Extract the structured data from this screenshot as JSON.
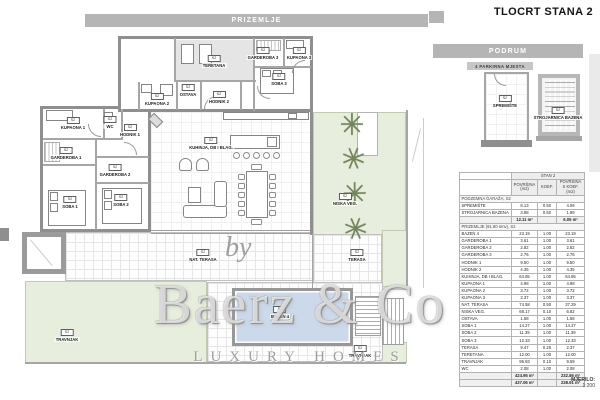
{
  "page": {
    "title": "TLOCRT STANA 2",
    "scale_label": "MJERILO:",
    "scale_value": "1:200"
  },
  "bars": {
    "prizemlje": "PRIZEMLJE",
    "podrum": "PODRUM",
    "parking": "4 PARKIRNA MJESTA"
  },
  "watermark": {
    "prefix": "by",
    "brand": "Baerz & Co",
    "tagline": "LUXURY HOMES"
  },
  "plan_labels": [
    {
      "id": "teretana",
      "tag": "S2",
      "name": "TERETANA"
    },
    {
      "id": "garderoba3",
      "tag": "S2",
      "name": "GARDEROBA 3"
    },
    {
      "id": "kupaona3",
      "tag": "S2",
      "name": "KUPAONA 3"
    },
    {
      "id": "soba3",
      "tag": "S2",
      "name": "SOBA 3"
    },
    {
      "id": "ostava",
      "tag": "S2",
      "name": "OSTAVA"
    },
    {
      "id": "hodnik2",
      "tag": "S2",
      "name": "HODNIK 2"
    },
    {
      "id": "kupaona2",
      "tag": "S2",
      "name": "KUPAONA 2"
    },
    {
      "id": "kupaona1",
      "tag": "S2",
      "name": "KUPAONA 1"
    },
    {
      "id": "wc",
      "tag": "S2",
      "name": "WC"
    },
    {
      "id": "hodnik1",
      "tag": "S2",
      "name": "HODNIK 1"
    },
    {
      "id": "garderoba1",
      "tag": "S2",
      "name": "GARDEROBA 1"
    },
    {
      "id": "garderoba2",
      "tag": "S2",
      "name": "GARDEROBA 2"
    },
    {
      "id": "soba1",
      "tag": "S2",
      "name": "SOBA 1"
    },
    {
      "id": "soba2",
      "tag": "S2",
      "name": "SOBA 2"
    },
    {
      "id": "kuhinja",
      "tag": "S2",
      "name": "KUHINJA, DB I BLAG."
    },
    {
      "id": "niskaveg",
      "tag": "S2",
      "name": "NISKA VEG."
    },
    {
      "id": "natterasa",
      "tag": "S2",
      "name": "NAT. TERASA"
    },
    {
      "id": "terasa",
      "tag": "S2",
      "name": "TERASA"
    },
    {
      "id": "bazen",
      "tag": "S2",
      "name": "BAZEN 4"
    },
    {
      "id": "travnjak1",
      "tag": "S2",
      "name": "TRAVNJAK"
    },
    {
      "id": "travnjak2",
      "tag": "S2",
      "name": "TRAVNJAK"
    },
    {
      "id": "spremiste",
      "tag": "S2",
      "name": "SPREMIŠTE"
    },
    {
      "id": "strojarnica",
      "tag": "S2",
      "name": "STROJARNICA BAZENA"
    }
  ],
  "table": {
    "title": "STAN 2",
    "columns": [
      "POVRŠINA (m2)",
      "KOEF.",
      "POVRŠINA S KOEF. (m2)"
    ],
    "sections": [
      {
        "header": "PODZEMNA GARAŽA, S2",
        "rows": [
          [
            "SPREMIŠTE",
            "8.13",
            "0.50",
            "4.06"
          ],
          [
            "STROJARNICA BAZENA",
            "3.98",
            "0.50",
            "1.99"
          ]
        ],
        "subtotal": [
          "12.11 m²",
          "",
          "6.05 m²"
        ]
      },
      {
        "header": "PRIZEMLJE (91.80 mnv), S2",
        "rows": [
          [
            "BAZEN 4",
            "23.19",
            "1.00",
            "23.19"
          ],
          [
            "GARDEROBA 1",
            "3.61",
            "1.00",
            "3.61"
          ],
          [
            "GARDEROBA 2",
            "2.82",
            "1.00",
            "2.82"
          ],
          [
            "GARDEROBA 3",
            "2.76",
            "1.00",
            "2.76"
          ],
          [
            "HODNIK 1",
            "9.50",
            "1.00",
            "9.50"
          ],
          [
            "HODNIK 2",
            "4.35",
            "1.00",
            "4.35"
          ],
          [
            "KUHINJA, DB I BLAG.",
            "64.85",
            "1.00",
            "64.85"
          ],
          [
            "KUPAONA 1",
            "4.98",
            "1.00",
            "4.98"
          ],
          [
            "KUPAONA 2",
            "3.72",
            "1.00",
            "3.72"
          ],
          [
            "KUPAONA 3",
            "3.37",
            "1.00",
            "3.37"
          ],
          [
            "NAT. TERASA",
            "74.58",
            "0.50",
            "37.29"
          ],
          [
            "NISKA VEG.",
            "68.17",
            "0.10",
            "6.82"
          ],
          [
            "OSTAVA",
            "1.58",
            "1.00",
            "1.58"
          ],
          [
            "SOBA 1",
            "14.27",
            "1.00",
            "14.27"
          ],
          [
            "SOBA 2",
            "11.39",
            "1.00",
            "11.39"
          ],
          [
            "SOBA 3",
            "12.33",
            "1.00",
            "12.33"
          ],
          [
            "TERASA",
            "9.47",
            "0.25",
            "2.37"
          ],
          [
            "TERETANA",
            "12.00",
            "1.00",
            "12.00"
          ],
          [
            "TRAVNJAK",
            "95.93",
            "0.10",
            "9.59"
          ],
          [
            "WC",
            "2.08",
            "1.00",
            "2.08"
          ]
        ],
        "subtotal": [
          "424.95 m²",
          "",
          "232.86 m²"
        ]
      }
    ],
    "grand_total": [
      "437.06 m²",
      "",
      "238.91 m²"
    ]
  }
}
